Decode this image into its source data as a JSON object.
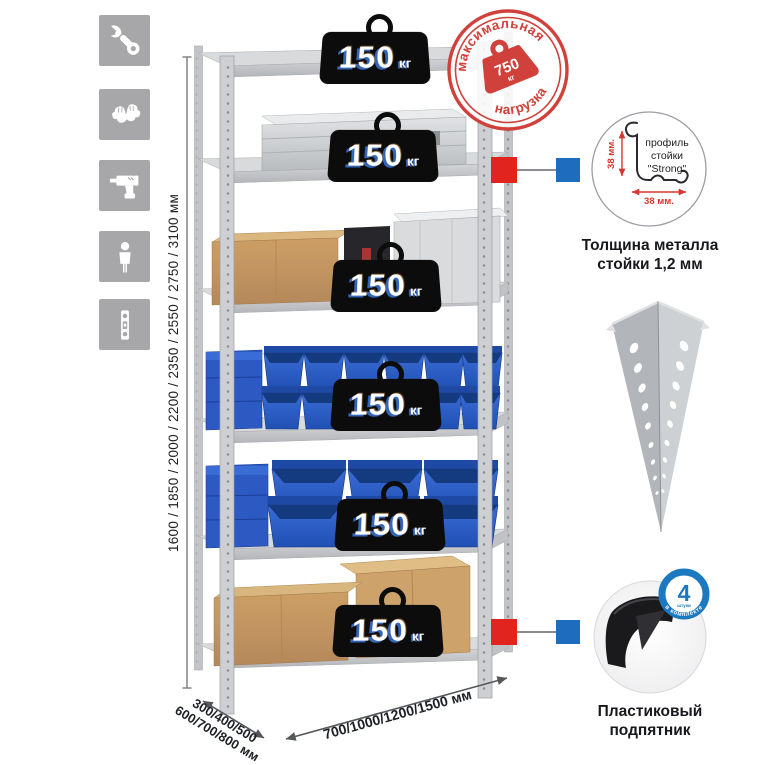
{
  "meta": {
    "language": "ru",
    "kind": "shelving-rack-product-infographic"
  },
  "colors": {
    "stamp_red": "#d0413c",
    "marker_red": "#e2241f",
    "marker_blue": "#1d6cbd",
    "bin_blue": "#2b5ec9",
    "badge_ring_blue": "#1c79c0",
    "tile_gray": "#a7a7a9"
  },
  "sidebar": {
    "icons": [
      {
        "name": "wrench-icon"
      },
      {
        "name": "gloves-icon"
      },
      {
        "name": "drill-icon"
      },
      {
        "name": "person-icon"
      },
      {
        "name": "level-icon"
      }
    ]
  },
  "load": {
    "shelf_value": "150",
    "shelf_unit": "кг"
  },
  "stamp": {
    "arc_top": "максимальная",
    "arc_bottom": "нагрузка",
    "value": "750",
    "unit": "кг"
  },
  "dimensions": {
    "height": "1600 / 1850 / 2000 / 2200 / 2350 / 2550 / 2750 / 3100 мм",
    "depth_line1": "300/400/500",
    "depth_line2": "600/700/800 мм",
    "width": "700/1000/1200/1500 мм"
  },
  "profile_callout": {
    "label_line1": "профиль",
    "label_line2": "стойки",
    "label_line3": "\"Strong\"",
    "dim_vertical": "38 мм.",
    "dim_horizontal": "38 мм.",
    "caption_line1": "Толщина металла",
    "caption_line2": "стойки 1,2 мм"
  },
  "foot_callout": {
    "badge_number": "4",
    "badge_subtext": "штуки",
    "badge_arc": "в комплекте",
    "caption_line1": "Пластиковый",
    "caption_line2": "подпятник"
  }
}
